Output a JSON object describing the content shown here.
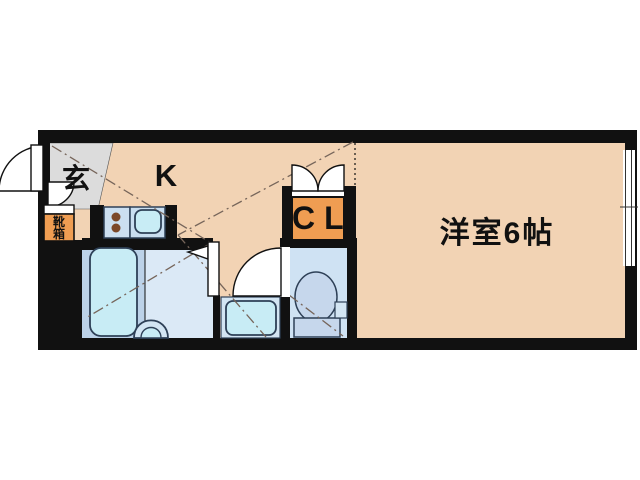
{
  "title": "1K apartment floor plan",
  "rooms": {
    "entrance": {
      "label": "玄"
    },
    "kitchen": {
      "label": "K"
    },
    "closet": {
      "label": "CL"
    },
    "western_room": {
      "label": "洋室6帖"
    },
    "shoe_box": {
      "label": "靴箱",
      "line1": "靴",
      "line2": "箱"
    }
  },
  "fixtures": {
    "bathtub": "bathtub",
    "wash_basin": "wash-basin",
    "washing_machine_pan": "washing-machine-pan",
    "toilet": "toilet",
    "stove": "two-burner-stove",
    "kitchen_sink": "kitchen-sink",
    "window": "window",
    "entry_door": "entry-door",
    "bathroom_door": "bathroom-door",
    "toilet_door": "toilet-door",
    "closet_bifold_doors": "closet-bifold-doors"
  },
  "colors": {
    "wall": "#111111",
    "floor_peach": "#f2d3b4",
    "entrance_gray": "#dcdcdc",
    "accent_orange": "#ef9d52",
    "bath_floor_left": "#bcd2e8",
    "bath_floor_right": "#dbe9f6",
    "toilet_floor": "#cfe2f3",
    "fixture_cyan": "#c8ecf5",
    "counter_blue": "#c9def0",
    "stove_blue": "#ccdff0",
    "toilet_porcelain": "#c6d7ec",
    "pan_frame_blue": "#d3e5f3",
    "burner_brown": "#7b4728",
    "guide_line": "#76655a",
    "outline_navy": "#2e4057"
  }
}
